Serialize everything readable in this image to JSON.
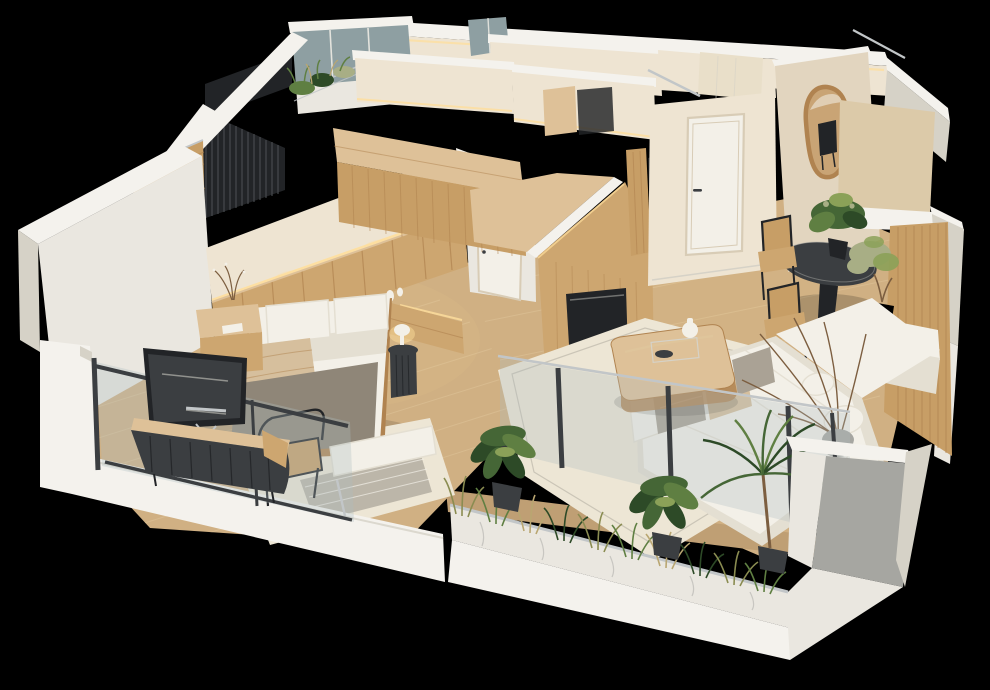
{
  "meta": {
    "description": "Photorealistic 3D isometric cutaway (dollhouse) rendering of a modern apartment floor plan on a black background",
    "view": "axonometric top-down cutaway, walls sliced white on top",
    "style": "warm minimalist interior, oak wood and cream tones"
  },
  "palette": {
    "black": "#000000",
    "wallTop": "#f4f2ed",
    "wallFace": "#eae7e0",
    "wallShade": "#d6d2c7",
    "wallDark": "#c2bcae",
    "shadowGrey": "#a6a6a1",
    "cream": "#eee4d2",
    "creamDeep": "#e2d5bf",
    "tanWall": "#dccaa9",
    "tiled": "#e9dfc9",
    "woodTop": "#dec198",
    "wood": "#cda670",
    "woodDark": "#b08350",
    "woodSlat": "#c79e66",
    "floor": "#d0b083",
    "floorLight": "#e0c69c",
    "floorShade": "#bf9f74",
    "dark": "#3b3e41",
    "darker": "#222427",
    "slatLine": "#4a4e51",
    "metal": "#c2c6c8",
    "glass": "#aebdc0",
    "glassCool": "#8e9fa2",
    "linen": "#f3f0e8",
    "linenShade": "#e4dfd2",
    "greyCushion": "#aaa295",
    "beigeThrow": "#d6bf9d",
    "greyBlanket": "#8f8678",
    "rug": "#ede6d5",
    "rugGrey": "#bcb6a9",
    "greenDark": "#2d4a27",
    "green": "#456636",
    "greenMid": "#5f7f42",
    "greenLight": "#8ba158",
    "sage": "#a8ae85",
    "grassOlive": "#8a8c51",
    "grassTan": "#b9a671",
    "branch": "#7c5e40",
    "glow": "#ffdf9d",
    "mirrorFrame": "#a1713d",
    "mirrorGlass": "#c9a475",
    "doorFrame": "#d8ccb6"
  },
  "scene": {
    "rooms": [
      {
        "id": "bedroom",
        "label": "Bedroom",
        "furniture": [
          "double bed with white pillows",
          "beige and grey throw blankets",
          "oak headboard panel wall with warm LED light",
          "wood nightstand with book",
          "black ribbed side table with mushroom lamp",
          "white bench at bed foot",
          "striped area rug",
          "wall-mounted TV",
          "dark ribbed media console",
          "wood-slat roller blind window"
        ]
      },
      {
        "id": "bedroom-balcony",
        "label": "Bedroom balcony",
        "furniture": [
          "glass partition with dark frame",
          "rattan lounge chair",
          "wood deck floor"
        ]
      },
      {
        "id": "hallway",
        "label": "Hallway / entry",
        "furniture": [
          "white entry door with handle",
          "organic-shaped wood-framed mirror reflecting dining chairs",
          "oak wardrobe volumes with slatted fronts",
          "dark framed artwork",
          "dresser with white vases"
        ]
      },
      {
        "id": "dining",
        "label": "Dining area",
        "furniture": [
          "black oval dining table",
          "two cane-back wood chairs",
          "leafy plant on table",
          "potted olive tree",
          "built-in bench with white cushions",
          "vertical wood-slat wall"
        ]
      },
      {
        "id": "living",
        "label": "Living room",
        "furniture": [
          "large white L-shaped sofa with cushions",
          "grey vase with dried branches",
          "oak coffee table with white vase and bowl",
          "cream rug",
          "wood-clad TV wall with black recess"
        ]
      },
      {
        "id": "living-balcony",
        "label": "Living balcony",
        "furniture": [
          "glass balustrade with dark posts",
          "long planter box full of ornamental grasses",
          "two broad-leaf potted plants",
          "potted palm"
        ]
      },
      {
        "id": "upper-terrace",
        "label": "Upper terrace / stairwell",
        "furniture": [
          "dark slatted railing",
          "glazed window band",
          "planter with greenery"
        ]
      }
    ],
    "background": "solid black"
  }
}
